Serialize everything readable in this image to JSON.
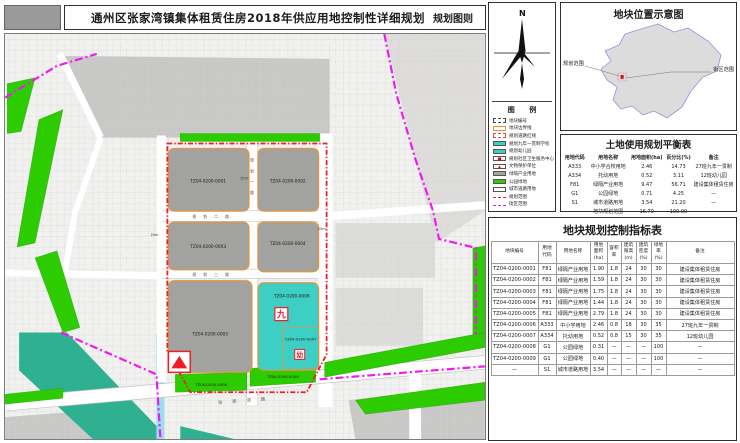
{
  "title_bar": {
    "title": "通州区张家湾镇集体租赁住房2018年供应用地控制性详细规划",
    "right_label": "规划图则"
  },
  "compass": {
    "north": "N"
  },
  "legend": {
    "title": "图  例",
    "items": [
      {
        "label": "地块编号",
        "type": "box-dashed",
        "stroke": "#444444"
      },
      {
        "label": "地块边界线",
        "type": "box-border",
        "stroke": "#e8923a"
      },
      {
        "label": "规划道路红线",
        "type": "box-dashed",
        "stroke": "#d94f4f"
      },
      {
        "label": "规划九年一贯制学校",
        "type": "box-solid",
        "fill": "#3ecfc4"
      },
      {
        "label": "规划幼儿园",
        "type": "box-solid",
        "fill": "#3ecfc4"
      },
      {
        "label": "规划社区卫生服务中心",
        "type": "box-glyph",
        "glyph": "■"
      },
      {
        "label": "文物保护单位",
        "type": "box-glyph",
        "glyph": "▲"
      },
      {
        "label": "绿隔产业用地",
        "type": "box-solid",
        "fill": "#a2a2a0"
      },
      {
        "label": "公园绿地",
        "type": "box-solid",
        "fill": "#2ccc00"
      },
      {
        "label": "城市道路用地",
        "type": "box-solid",
        "fill": "#ffffff"
      },
      {
        "label": "规划范围",
        "type": "line-dash",
        "stroke": "#ee1c25"
      },
      {
        "label": "街区范围",
        "type": "line-dash",
        "stroke": "#f118f1"
      }
    ]
  },
  "location_map": {
    "title": "地块位置示意图",
    "label_left": "规划范围",
    "label_right": "街区范围"
  },
  "balance_table": {
    "title": "土地使用规划平衡表",
    "headers": [
      "用地代码",
      "用地名称",
      "用地面积(ha)",
      "百分比(%)",
      "备注"
    ],
    "rows": [
      [
        "A333",
        "中小学合校用地",
        "2.46",
        "14.73",
        "27班九年一贯制"
      ],
      [
        "A334",
        "托幼用地",
        "0.52",
        "3.11",
        "12班幼儿园"
      ],
      [
        "F81",
        "绿隔产业用地",
        "9.47",
        "56.71",
        "建设集体租赁住房"
      ],
      [
        "G1",
        "公园绿地",
        "0.71",
        "4.25",
        "—"
      ],
      [
        "S1",
        "城市道路用地",
        "3.54",
        "21.20",
        "—"
      ],
      [
        "",
        "地块规划范围",
        "16.70",
        "100.00",
        "—"
      ]
    ]
  },
  "indicator_table": {
    "title": "地块规划控制指标表",
    "headers": [
      "地块编号",
      "用地\n代码",
      "用地名称",
      "用地\n面积\n(ha)",
      "容积\n率",
      "建筑\n限高\n(m)",
      "建筑\n密度\n(%)",
      "绿地\n率\n(%)",
      "备注"
    ],
    "rows": [
      [
        "TZ04-0200-0001",
        "F81",
        "绿隔产业用地",
        "1.90",
        "1.8",
        "24",
        "30",
        "30",
        "建设集体租赁住房"
      ],
      [
        "TZ04-0200-0002",
        "F81",
        "绿隔产业用地",
        "1.59",
        "1.8",
        "24",
        "30",
        "30",
        "建设集体租赁住房"
      ],
      [
        "TZ04-0200-0003",
        "F81",
        "绿隔产业用地",
        "1.75",
        "1.8",
        "24",
        "30",
        "30",
        "建设集体租赁住房"
      ],
      [
        "TZ04-0200-0004",
        "F81",
        "绿隔产业用地",
        "1.44",
        "1.8",
        "24",
        "30",
        "30",
        "建设集体租赁住房"
      ],
      [
        "TZ04-0200-0005",
        "F81",
        "绿隔产业用地",
        "2.79",
        "1.8",
        "24",
        "30",
        "30",
        "建设集体租赁住房"
      ],
      [
        "TZ04-0200-0006",
        "A333",
        "中小学用地",
        "2.46",
        "0.8",
        "18",
        "30",
        "35",
        "27班九年一贯制"
      ],
      [
        "TZ04-0200-0007",
        "A334",
        "托幼用地",
        "0.52",
        "0.8",
        "15",
        "30",
        "35",
        "12班幼儿园"
      ],
      [
        "TZ04-0200-0008",
        "G1",
        "公园绿地",
        "0.31",
        "—",
        "—",
        "—",
        "100",
        "—"
      ],
      [
        "TZ04-0200-0009",
        "G1",
        "公园绿地",
        "0.40",
        "—",
        "—",
        "—",
        "100",
        "—"
      ],
      [
        "—",
        "S1",
        "城市道路用地",
        "3.54",
        "—",
        "—",
        "—",
        "—",
        "—"
      ]
    ]
  },
  "map": {
    "plots": [
      {
        "id": "TZ04-0200-0001"
      },
      {
        "id": "TZ04-0200-0002"
      },
      {
        "id": "TZ04-0200-0003"
      },
      {
        "id": "TZ04-0200-0004"
      },
      {
        "id": "TZ04-0200-0005"
      },
      {
        "id": "TZ04-0200-0006"
      },
      {
        "id": "TZ04-0200-0007"
      },
      {
        "id": "TZ04-0200-0008"
      },
      {
        "id": "TZ04-0200-0009"
      }
    ],
    "markers": {
      "nine_year_school": "九",
      "kindergarten": "幼"
    },
    "road_labels": {
      "vertical": "规划一路",
      "mid": "规划二路",
      "lower": "规划三路",
      "arterial": "张家湾路"
    },
    "width_labels": {
      "a": "15m",
      "b": "20m",
      "c": "25m"
    }
  },
  "colors": {
    "plot_gray": "#a2a2a0",
    "school_teal": "#3ecfc4",
    "park_green": "#2ccc00",
    "boundary_red": "#ee1c25",
    "block_boundary_magenta": "#f118f1",
    "plot_border_orange": "#e8923a",
    "water_teal": "#2fb091"
  }
}
